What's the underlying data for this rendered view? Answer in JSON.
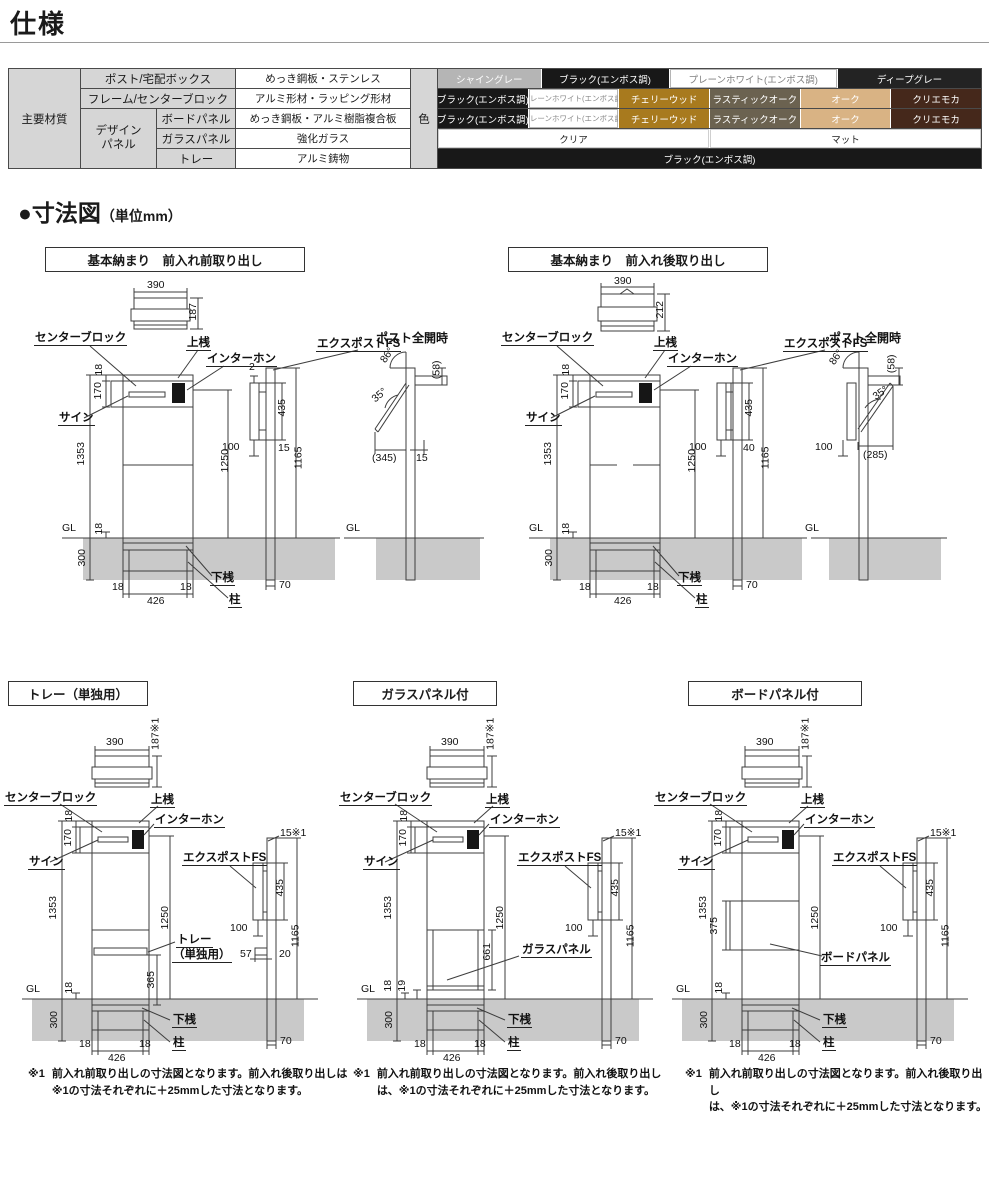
{
  "page": {
    "title": "仕様"
  },
  "section": {
    "title": "●寸法図",
    "unit": "（単位mm）"
  },
  "spec_table": {
    "main_header": "主要材質",
    "color_header": "色",
    "design_group": {
      "line1": "デザイン",
      "line2": "パネル"
    },
    "rows": [
      {
        "label": "ポスト/宅配ボックス",
        "material": "めっき鋼板・ステンレス"
      },
      {
        "label": "フレーム/センターブロック",
        "material": "アルミ形材・ラッピング形材"
      },
      {
        "label": "ボードパネル",
        "material": "めっき鋼板・アルミ樹脂複合板"
      },
      {
        "label": "ガラスパネル",
        "material": "強化ガラス"
      },
      {
        "label": "トレー",
        "material": "アルミ鋳物"
      }
    ],
    "colors": {
      "post": [
        {
          "label": "シャイングレー",
          "style": "width:19%;background:#b5b5b5;color:#fff"
        },
        {
          "label": "ブラック(エンボス調)",
          "style": "width:23.5%;background:#181818;color:#fff"
        },
        {
          "label": "プレーンホワイト(エンボス調)",
          "style": "width:31%;background:#fff;color:#808080;box-shadow:inset 0 0 0 1px #b5b5b5"
        },
        {
          "label": "ディープグレー",
          "style": "width:26.5%;background:#232323;color:#fff"
        }
      ],
      "frame": [
        {
          "label": "ブラック(エンボス調)",
          "style": "width:16.66%;background:#181818;color:#fff"
        },
        {
          "label": "プレーンホワイト(エンボス調)",
          "style": "width:16.66%;background:#fff;color:#8a8a8a;box-shadow:inset 0 0 0 1px #b5b5b5;font-size:7.5px"
        },
        {
          "label": "チェリーウッド",
          "style": "width:16.66%;background:#a87a1e;color:#fff"
        },
        {
          "label": "ラスティックオーク",
          "style": "width:16.66%;background:#6b6250;color:#fff"
        },
        {
          "label": "オーク",
          "style": "width:16.66%;background:#d9b384;color:#fff"
        },
        {
          "label": "クリエモカ",
          "style": "width:16.67%;background:#45281b;color:#fff"
        }
      ],
      "board": [
        {
          "label": "ブラック(エンボス調)",
          "style": "width:16.66%;background:#181818;color:#fff"
        },
        {
          "label": "プレーンホワイト(エンボス調)",
          "style": "width:16.66%;background:#fff;color:#8a8a8a;box-shadow:inset 0 0 0 1px #b5b5b5;font-size:7.5px"
        },
        {
          "label": "チェリーウッド",
          "style": "width:16.66%;background:#a87a1e;color:#fff"
        },
        {
          "label": "ラスティックオーク",
          "style": "width:16.66%;background:#6b6250;color:#fff"
        },
        {
          "label": "オーク",
          "style": "width:16.66%;background:#d9b384;color:#fff"
        },
        {
          "label": "クリエモカ",
          "style": "width:16.67%;background:#45281b;color:#fff"
        }
      ],
      "glass": [
        {
          "label": "クリア",
          "style": "width:50%;background:#fff;color:#222;box-shadow:inset 0 0 0 1px #cfcfcf"
        },
        {
          "label": "マット",
          "style": "width:50%;background:#fff;color:#222;box-shadow:inset 0 0 0 1px #cfcfcf"
        }
      ],
      "tray": [
        {
          "label": "ブラック(エンボス調)",
          "style": "width:100%;background:#181818;color:#fff"
        }
      ]
    }
  },
  "diagrams": [
    {
      "title": "基本納まり　前入れ前取り出し",
      "labels": [
        {
          "t": "390",
          "x": 119,
          "y": 0
        },
        {
          "t": "187",
          "x": 157,
          "y": 26,
          "r": -90
        },
        {
          "t": "センターブロック",
          "x": 6,
          "y": 52,
          "c": "u"
        },
        {
          "t": "上桟",
          "x": 158,
          "y": 57,
          "c": "u"
        },
        {
          "t": "インターホン",
          "x": 178,
          "y": 73,
          "c": "u"
        },
        {
          "t": "サイン",
          "x": 30,
          "y": 132,
          "c": "u"
        },
        {
          "t": "18",
          "x": 66,
          "y": 84,
          "r": -90
        },
        {
          "t": "170",
          "x": 62,
          "y": 105,
          "r": -90
        },
        {
          "t": "1353",
          "x": 42,
          "y": 168,
          "r": -90
        },
        {
          "t": "18",
          "x": 66,
          "y": 243,
          "r": -90
        },
        {
          "t": "300",
          "x": 46,
          "y": 272,
          "r": -90
        },
        {
          "t": "1250",
          "x": 186,
          "y": 175,
          "r": -90
        },
        {
          "t": "GL",
          "x": 34,
          "y": 243
        },
        {
          "t": "下桟",
          "x": 182,
          "y": 292,
          "c": "u"
        },
        {
          "t": "柱",
          "x": 200,
          "y": 314,
          "c": "u"
        },
        {
          "t": "18",
          "x": 84,
          "y": 302
        },
        {
          "t": "426",
          "x": 119,
          "y": 316
        },
        {
          "t": "18",
          "x": 152,
          "y": 302
        },
        {
          "t": "2",
          "x": 221,
          "y": 82
        },
        {
          "t": "エクスポストFS",
          "x": 288,
          "y": 58,
          "c": "u"
        },
        {
          "t": "435",
          "x": 246,
          "y": 122,
          "r": -90
        },
        {
          "t": "100",
          "x": 194,
          "y": 162
        },
        {
          "t": "15",
          "x": 250,
          "y": 163
        },
        {
          "t": "1165",
          "x": 260,
          "y": 172,
          "r": -90
        },
        {
          "t": "70",
          "x": 251,
          "y": 300
        },
        {
          "t": "ポスト全開時",
          "x": 348,
          "y": 52,
          "c": "b"
        },
        {
          "t": "86°",
          "x": 352,
          "y": 70,
          "r": -55
        },
        {
          "t": "35°",
          "x": 344,
          "y": 110,
          "r": -40
        },
        {
          "t": "(58)",
          "x": 400,
          "y": 84,
          "r": -90
        },
        {
          "t": "(345)",
          "x": 344,
          "y": 173
        },
        {
          "t": "15",
          "x": 388,
          "y": 173
        },
        {
          "t": "GL",
          "x": 318,
          "y": 243
        }
      ]
    },
    {
      "title": "基本納まり　前入れ後取り出し",
      "labels": [
        {
          "t": "390",
          "x": 119,
          "y": -4
        },
        {
          "t": "212",
          "x": 157,
          "y": 24,
          "r": -90
        },
        {
          "t": "センターブロック",
          "x": 6,
          "y": 52,
          "c": "u"
        },
        {
          "t": "上桟",
          "x": 158,
          "y": 57,
          "c": "u"
        },
        {
          "t": "インターホン",
          "x": 172,
          "y": 73,
          "c": "u"
        },
        {
          "t": "サイン",
          "x": 30,
          "y": 132,
          "c": "u"
        },
        {
          "t": "18",
          "x": 66,
          "y": 84,
          "r": -90
        },
        {
          "t": "170",
          "x": 62,
          "y": 105,
          "r": -90
        },
        {
          "t": "1353",
          "x": 42,
          "y": 168,
          "r": -90
        },
        {
          "t": "18",
          "x": 66,
          "y": 243,
          "r": -90
        },
        {
          "t": "300",
          "x": 46,
          "y": 272,
          "r": -90
        },
        {
          "t": "1250",
          "x": 186,
          "y": 175,
          "r": -90
        },
        {
          "t": "GL",
          "x": 34,
          "y": 243
        },
        {
          "t": "下桟",
          "x": 182,
          "y": 292,
          "c": "u"
        },
        {
          "t": "柱",
          "x": 200,
          "y": 314,
          "c": "u"
        },
        {
          "t": "18",
          "x": 84,
          "y": 302
        },
        {
          "t": "426",
          "x": 119,
          "y": 316
        },
        {
          "t": "18",
          "x": 152,
          "y": 302
        },
        {
          "t": "エクスポストFS",
          "x": 288,
          "y": 58,
          "c": "u"
        },
        {
          "t": "435",
          "x": 246,
          "y": 122,
          "r": -90
        },
        {
          "t": "100",
          "x": 194,
          "y": 162
        },
        {
          "t": "40",
          "x": 248,
          "y": 163
        },
        {
          "t": "1165",
          "x": 260,
          "y": 172,
          "r": -90
        },
        {
          "t": "70",
          "x": 251,
          "y": 300
        },
        {
          "t": "ポスト全開時",
          "x": 334,
          "y": 52,
          "c": "b"
        },
        {
          "t": "86°",
          "x": 334,
          "y": 72,
          "r": -55
        },
        {
          "t": "35°",
          "x": 378,
          "y": 108,
          "r": -35
        },
        {
          "t": "(58)",
          "x": 388,
          "y": 78,
          "r": -90
        },
        {
          "t": "(285)",
          "x": 368,
          "y": 170
        },
        {
          "t": "100",
          "x": 320,
          "y": 162
        },
        {
          "t": "GL",
          "x": 310,
          "y": 243
        }
      ]
    },
    {
      "title": "トレー（単独用）",
      "labels": [
        {
          "t": "390",
          "x": 104,
          "y": 47
        },
        {
          "t": "187※1",
          "x": 138,
          "y": 38,
          "r": -90
        },
        {
          "t": "センターブロック",
          "x": 2,
          "y": 102,
          "c": "u"
        },
        {
          "t": "上桟",
          "x": 148,
          "y": 104,
          "c": "u"
        },
        {
          "t": "インターホン",
          "x": 152,
          "y": 124,
          "c": "u"
        },
        {
          "t": "サイン",
          "x": 26,
          "y": 166,
          "c": "u"
        },
        {
          "t": "18",
          "x": 62,
          "y": 120,
          "r": -90
        },
        {
          "t": "170",
          "x": 58,
          "y": 142,
          "r": -90
        },
        {
          "t": "1353",
          "x": 40,
          "y": 212,
          "r": -90
        },
        {
          "t": "1250",
          "x": 152,
          "y": 222,
          "r": -90
        },
        {
          "t": "365",
          "x": 141,
          "y": 284,
          "r": -90
        },
        {
          "t": "トレー",
          "x": 174,
          "y": 244,
          "c": "u"
        },
        {
          "t": "（単独用）",
          "x": 170,
          "y": 259,
          "c": "u"
        },
        {
          "t": "18",
          "x": 62,
          "y": 292,
          "r": -90
        },
        {
          "t": "300",
          "x": 44,
          "y": 324,
          "r": -90
        },
        {
          "t": "GL",
          "x": 24,
          "y": 294
        },
        {
          "t": "下桟",
          "x": 170,
          "y": 324,
          "c": "u"
        },
        {
          "t": "柱",
          "x": 170,
          "y": 347,
          "c": "u"
        },
        {
          "t": "18",
          "x": 77,
          "y": 349
        },
        {
          "t": "426",
          "x": 106,
          "y": 363
        },
        {
          "t": "18",
          "x": 137,
          "y": 349
        },
        {
          "t": "エクスポストFS",
          "x": 180,
          "y": 162,
          "c": "u"
        },
        {
          "t": "15※1",
          "x": 278,
          "y": 138
        },
        {
          "t": "435",
          "x": 270,
          "y": 192,
          "r": -90
        },
        {
          "t": "100",
          "x": 228,
          "y": 233
        },
        {
          "t": "1165",
          "x": 283,
          "y": 240,
          "r": -90
        },
        {
          "t": "57",
          "x": 238,
          "y": 259
        },
        {
          "t": "20",
          "x": 277,
          "y": 259
        },
        {
          "t": "70",
          "x": 278,
          "y": 346
        }
      ]
    },
    {
      "title": "ガラスパネル付",
      "labels": [
        {
          "t": "390",
          "x": 104,
          "y": 47
        },
        {
          "t": "187※1",
          "x": 138,
          "y": 38,
          "r": -90
        },
        {
          "t": "センターブロック",
          "x": 2,
          "y": 102,
          "c": "u"
        },
        {
          "t": "上桟",
          "x": 148,
          "y": 104,
          "c": "u"
        },
        {
          "t": "インターホン",
          "x": 152,
          "y": 124,
          "c": "u"
        },
        {
          "t": "サイン",
          "x": 26,
          "y": 166,
          "c": "u"
        },
        {
          "t": "18",
          "x": 62,
          "y": 120,
          "r": -90
        },
        {
          "t": "170",
          "x": 58,
          "y": 142,
          "r": -90
        },
        {
          "t": "1353",
          "x": 40,
          "y": 212,
          "r": -90
        },
        {
          "t": "1250",
          "x": 152,
          "y": 222,
          "r": -90
        },
        {
          "t": "661",
          "x": 142,
          "y": 256,
          "r": -90
        },
        {
          "t": "ガラスパネル",
          "x": 184,
          "y": 254,
          "c": "u"
        },
        {
          "t": "18",
          "x": 46,
          "y": 290,
          "r": -90
        },
        {
          "t": "19",
          "x": 60,
          "y": 290,
          "r": -90
        },
        {
          "t": "300",
          "x": 44,
          "y": 324,
          "r": -90
        },
        {
          "t": "GL",
          "x": 24,
          "y": 294
        },
        {
          "t": "下桟",
          "x": 170,
          "y": 324,
          "c": "u"
        },
        {
          "t": "柱",
          "x": 170,
          "y": 347,
          "c": "u"
        },
        {
          "t": "18",
          "x": 77,
          "y": 349
        },
        {
          "t": "426",
          "x": 106,
          "y": 363
        },
        {
          "t": "18",
          "x": 137,
          "y": 349
        },
        {
          "t": "エクスポストFS",
          "x": 180,
          "y": 162,
          "c": "u"
        },
        {
          "t": "15※1",
          "x": 278,
          "y": 138
        },
        {
          "t": "435",
          "x": 270,
          "y": 192,
          "r": -90
        },
        {
          "t": "100",
          "x": 228,
          "y": 233
        },
        {
          "t": "1165",
          "x": 283,
          "y": 240,
          "r": -90
        },
        {
          "t": "70",
          "x": 278,
          "y": 346
        }
      ]
    },
    {
      "title": "ボードパネル付",
      "labels": [
        {
          "t": "390",
          "x": 104,
          "y": 47
        },
        {
          "t": "187※1",
          "x": 138,
          "y": 38,
          "r": -90
        },
        {
          "t": "センターブロック",
          "x": 2,
          "y": 102,
          "c": "u"
        },
        {
          "t": "上桟",
          "x": 148,
          "y": 104,
          "c": "u"
        },
        {
          "t": "インターホン",
          "x": 152,
          "y": 124,
          "c": "u"
        },
        {
          "t": "サイン",
          "x": 26,
          "y": 166,
          "c": "u"
        },
        {
          "t": "18",
          "x": 62,
          "y": 120,
          "r": -90
        },
        {
          "t": "170",
          "x": 58,
          "y": 142,
          "r": -90
        },
        {
          "t": "1353",
          "x": 40,
          "y": 212,
          "r": -90
        },
        {
          "t": "375",
          "x": 54,
          "y": 230,
          "r": -90
        },
        {
          "t": "1250",
          "x": 152,
          "y": 222,
          "r": -90
        },
        {
          "t": "ボードパネル",
          "x": 168,
          "y": 262,
          "c": "u"
        },
        {
          "t": "18",
          "x": 62,
          "y": 292,
          "r": -90
        },
        {
          "t": "300",
          "x": 44,
          "y": 324,
          "r": -90
        },
        {
          "t": "GL",
          "x": 24,
          "y": 294
        },
        {
          "t": "下桟",
          "x": 170,
          "y": 324,
          "c": "u"
        },
        {
          "t": "柱",
          "x": 170,
          "y": 347,
          "c": "u"
        },
        {
          "t": "18",
          "x": 77,
          "y": 349
        },
        {
          "t": "426",
          "x": 106,
          "y": 363
        },
        {
          "t": "18",
          "x": 137,
          "y": 349
        },
        {
          "t": "エクスポストFS",
          "x": 180,
          "y": 162,
          "c": "u"
        },
        {
          "t": "15※1",
          "x": 278,
          "y": 138
        },
        {
          "t": "435",
          "x": 270,
          "y": 192,
          "r": -90
        },
        {
          "t": "100",
          "x": 228,
          "y": 233
        },
        {
          "t": "1165",
          "x": 283,
          "y": 240,
          "r": -90
        },
        {
          "t": "70",
          "x": 278,
          "y": 346
        }
      ]
    }
  ],
  "footnotes": [
    {
      "mark": "※1",
      "line1": "前入れ前取り出しの寸法図となります。前入れ後取り出しは",
      "line2": "※1の寸法それぞれに＋25mmした寸法となります。"
    },
    {
      "mark": "※1",
      "line1": "前入れ前取り出しの寸法図となります。前入れ後取り出し",
      "line2": "は、※1の寸法それぞれに＋25mmした寸法となります。"
    },
    {
      "mark": "※1",
      "line1": "前入れ前取り出しの寸法図となります。前入れ後取り出し",
      "line2": "は、※1の寸法それぞれに＋25mmした寸法となります。"
    }
  ]
}
